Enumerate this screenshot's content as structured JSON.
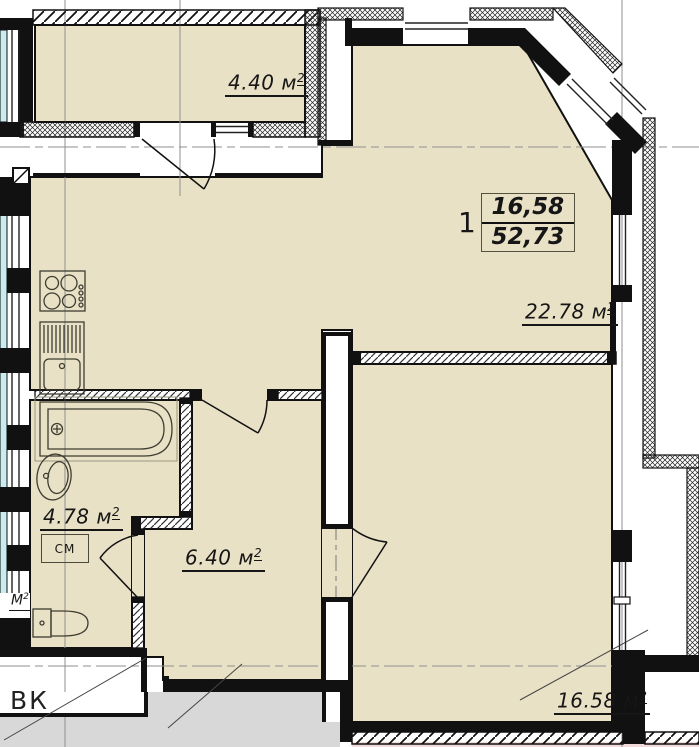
{
  "apartment": {
    "number": "1",
    "living_area": "16,58",
    "total_area": "52,73"
  },
  "rooms": [
    {
      "name": "balcony",
      "area": "4.40",
      "unit": "м",
      "sup": "2"
    },
    {
      "name": "kitchen-living-room",
      "area": "22.78",
      "unit": "м",
      "sup": "2"
    },
    {
      "name": "bathroom",
      "area": "4.78",
      "unit": "м",
      "sup": "2"
    },
    {
      "name": "hallway",
      "area": "6.40",
      "unit": "м",
      "sup": "2"
    },
    {
      "name": "bedroom",
      "area": "16.58",
      "unit": "м",
      "sup": "2"
    }
  ],
  "annotations": {
    "washing_machine": "СМ",
    "vent_shaft": "ВК",
    "neighbor_label": "М",
    "neighbor_sup": "2"
  },
  "colors": {
    "room_fill": "#e9e1c5",
    "wall": "#111111",
    "glazing": "#c9ecf0",
    "outside_gray": "#d8d8d8",
    "neighbor_strip": "#f2dada"
  }
}
